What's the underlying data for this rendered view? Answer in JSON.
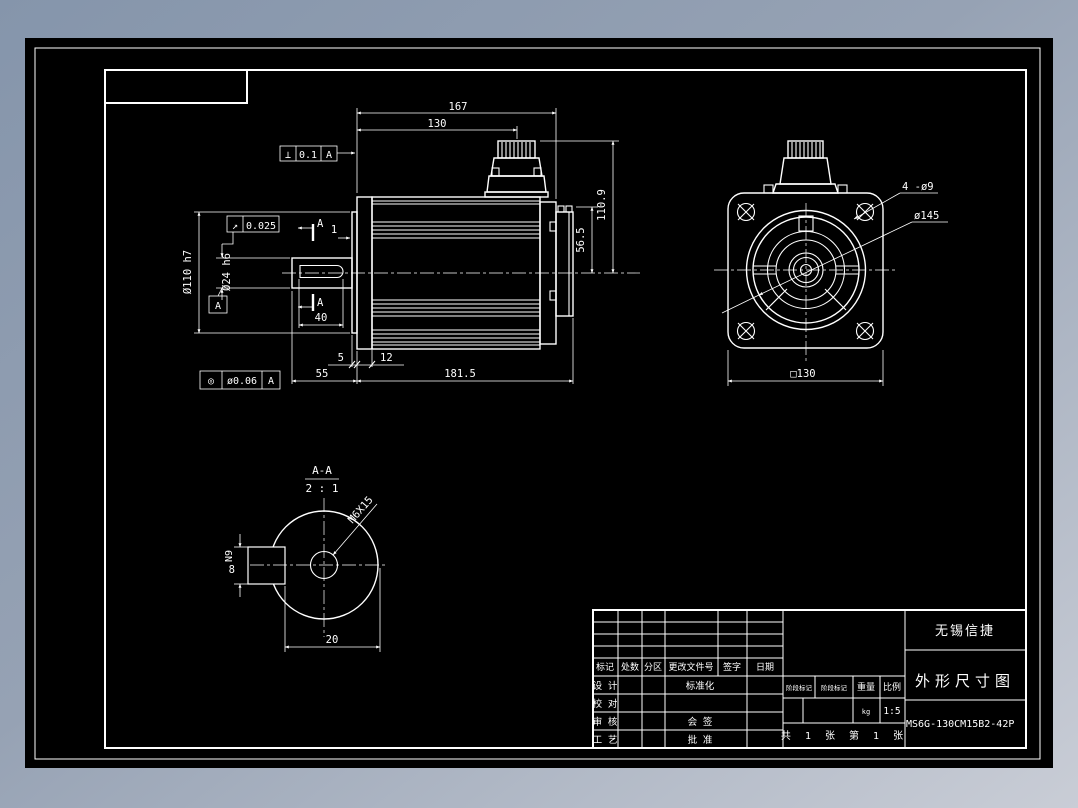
{
  "colors": {
    "page_top": "#8595ab",
    "page_bottom": "#c9cdd6",
    "canvas_bg": "#000000",
    "line": "#ffffff"
  },
  "views": {
    "side": {
      "d167": "167",
      "d130": "130",
      "d110_9": "110.9",
      "d56_5": "56.5",
      "d55": "55",
      "d181_5": "181.5",
      "d40": "40",
      "d5": "5",
      "d12": "12",
      "d1": "1",
      "dia110": "Ø110 h7",
      "dia24": "Ø24 h6",
      "perp_sym": "⊥",
      "perp_val": "0.1",
      "perp_datum": "A",
      "runout_sym": "↗",
      "runout_val": "0.025",
      "conc_sym": "◎",
      "conc_val": "ø0.06",
      "conc_datum": "A",
      "datum_label": "A",
      "section_label": "A"
    },
    "front": {
      "holes": "4 -ø9",
      "dia145": "ø145",
      "sq130": "□130"
    },
    "section": {
      "title": "A-A",
      "scale": "2 : 1",
      "key_w": "8",
      "key_tol": "N9",
      "d20": "20",
      "thread": "M6X15"
    }
  },
  "title_block": {
    "header": [
      "标记",
      "处数",
      "分区",
      "更改文件号",
      "签字",
      "日期"
    ],
    "roles": [
      "设 计",
      "校 对",
      "审 核",
      "工 艺"
    ],
    "mid": [
      "标准化",
      "会 签",
      "批 准"
    ],
    "stage1": "阶段标记",
    "stage2": "阶段标记",
    "weight_label": "重量",
    "scale_label": "比例",
    "weight_val": "kg",
    "scale_val": "1:5",
    "sheet": "共 1 张 第 1 张",
    "company": "无锡信捷",
    "drawing_title": "外形尺寸图",
    "part_no": "MS6G-130CM15B2-42P"
  }
}
